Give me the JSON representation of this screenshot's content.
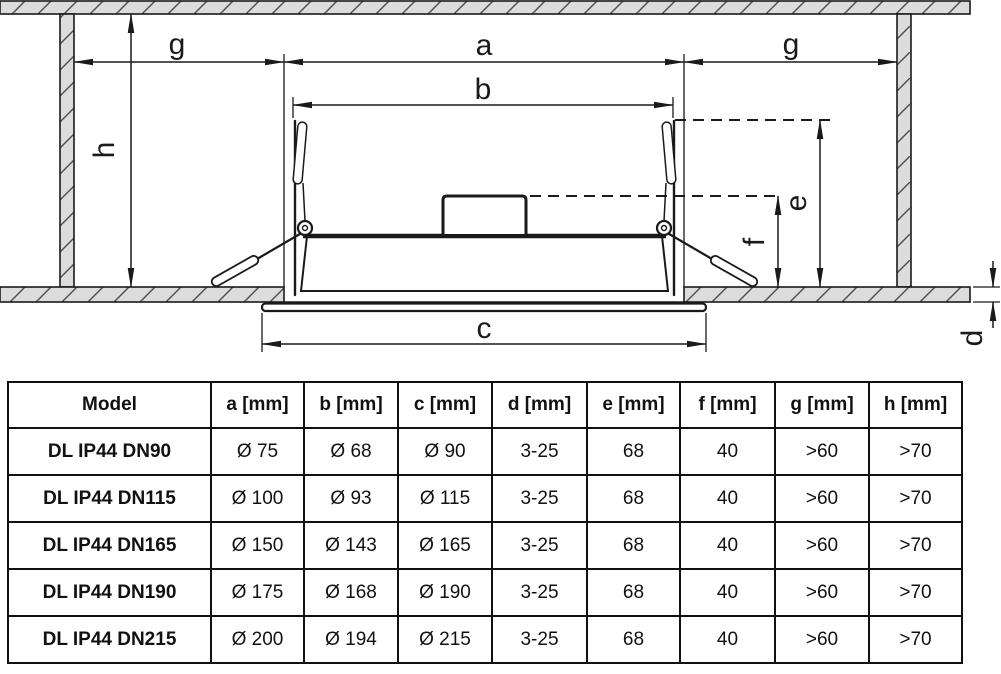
{
  "diagram": {
    "labels": {
      "a": "a",
      "b": "b",
      "c": "c",
      "d": "d",
      "e": "e",
      "f": "f",
      "g_left": "g",
      "g_right": "g",
      "h": "h"
    },
    "colors": {
      "line": "#1a1a1a",
      "hatch_fill": "#dcdcdc",
      "background": "#ffffff"
    }
  },
  "table": {
    "columns": [
      "Model",
      "a [mm]",
      "b [mm]",
      "c [mm]",
      "d [mm]",
      "e [mm]",
      "f [mm]",
      "g [mm]",
      "h [mm]"
    ],
    "rows": [
      [
        "DL IP44 DN90",
        "Ø 75",
        "Ø 68",
        "Ø 90",
        "3-25",
        "68",
        "40",
        ">60",
        ">70"
      ],
      [
        "DL IP44 DN115",
        "Ø 100",
        "Ø 93",
        "Ø 115",
        "3-25",
        "68",
        "40",
        ">60",
        ">70"
      ],
      [
        "DL IP44 DN165",
        "Ø 150",
        "Ø 143",
        "Ø 165",
        "3-25",
        "68",
        "40",
        ">60",
        ">70"
      ],
      [
        "DL IP44 DN190",
        "Ø 175",
        "Ø 168",
        "Ø 190",
        "3-25",
        "68",
        "40",
        ">60",
        ">70"
      ],
      [
        "DL IP44 DN215",
        "Ø 200",
        "Ø 194",
        "Ø 215",
        "3-25",
        "68",
        "40",
        ">60",
        ">70"
      ]
    ]
  }
}
